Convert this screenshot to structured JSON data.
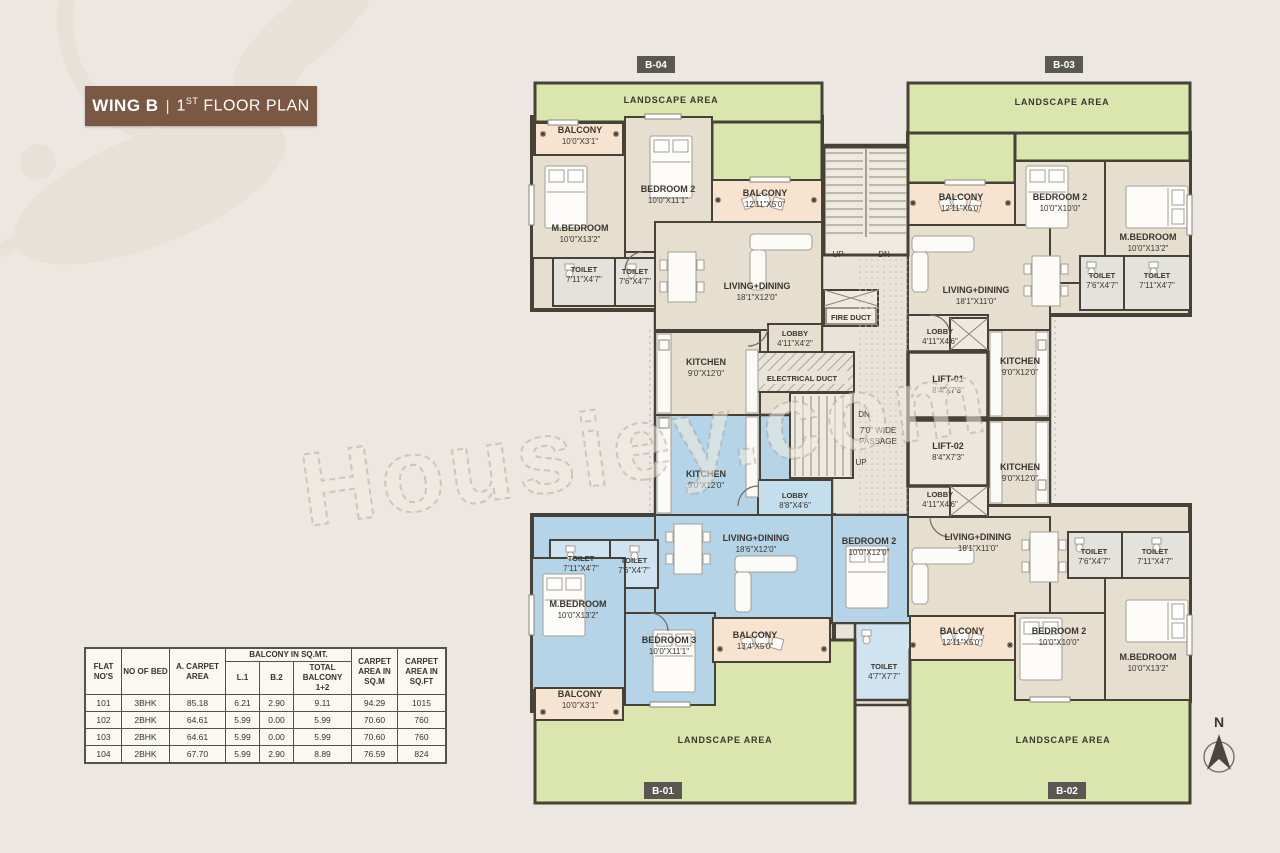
{
  "title": {
    "wing": "WING B",
    "sep": "|",
    "num": "1",
    "sup": "ST",
    "rest": " FLOOR PLAN"
  },
  "watermark": "Housiey.com",
  "compass": {
    "n": "N"
  },
  "badges": [
    "B-04",
    "B-03",
    "B-01",
    "B-02"
  ],
  "table": {
    "group_header": "BALCONY IN SQ.MT.",
    "columns": [
      "FLAT NO'S",
      "NO OF BED",
      "A. CARPET AREA",
      "L.1",
      "B.2",
      "TOTAL BALCONY 1+2",
      "CARPET AREA IN SQ.M",
      "CARPET AREA IN SQ.FT"
    ],
    "rows": [
      [
        "101",
        "3BHK",
        "85.18",
        "6.21",
        "2.90",
        "9.11",
        "94.29",
        "1015"
      ],
      [
        "102",
        "2BHK",
        "64.61",
        "5.99",
        "0.00",
        "5.99",
        "70.60",
        "760"
      ],
      [
        "103",
        "2BHK",
        "64.61",
        "5.99",
        "0.00",
        "5.99",
        "70.60",
        "760"
      ],
      [
        "104",
        "2BHK",
        "67.70",
        "5.99",
        "2.90",
        "8.89",
        "76.59",
        "824"
      ]
    ]
  },
  "plan": {
    "rooms": [
      {
        "n": "LANDSCAPE AREA",
        "d": ""
      },
      {
        "n": "BALCONY",
        "d": "10'0\"X3'1\""
      },
      {
        "n": "BEDROOM 2",
        "d": "10'0\"X11'1\""
      },
      {
        "n": "BALCONY",
        "d": "12'11\"X5'0\""
      },
      {
        "n": "M.BEDROOM",
        "d": "10'0\"X13'2\""
      },
      {
        "n": "TOILET",
        "d": "7'11\"X4'7\""
      },
      {
        "n": "TOILET",
        "d": "7'6\"X4'7\""
      },
      {
        "n": "LIVING+DINING",
        "d": "18'1\"X12'0\""
      },
      {
        "n": "KITCHEN",
        "d": "9'0\"X12'0\""
      },
      {
        "n": "LOBBY",
        "d": "4'11\"X4'2\""
      },
      {
        "n": "UP",
        "d": ""
      },
      {
        "n": "DN",
        "d": ""
      },
      {
        "n": "FIRE DUCT",
        "d": ""
      },
      {
        "n": "ELECTRICAL DUCT",
        "d": ""
      },
      {
        "n": "DN",
        "d": ""
      },
      {
        "n": "7'0\" WIDE",
        "d": "PASSAGE"
      },
      {
        "n": "UP",
        "d": ""
      },
      {
        "n": "LIFT-01",
        "d": "8'4\"X7'3\""
      },
      {
        "n": "LIFT-02",
        "d": "8'4\"X7'3\""
      },
      {
        "n": "LOBBY",
        "d": "4'11\"X4'6\""
      },
      {
        "n": "LANDSCAPE AREA",
        "d": ""
      },
      {
        "n": "BALCONY",
        "d": "12'11\"X5'0\""
      },
      {
        "n": "BEDROOM 2",
        "d": "10'0\"X10'0\""
      },
      {
        "n": "M.BEDROOM",
        "d": "10'0\"X13'2\""
      },
      {
        "n": "TOILET",
        "d": "7'6\"X4'7\""
      },
      {
        "n": "TOILET",
        "d": "7'11\"X4'7\""
      },
      {
        "n": "LIVING+DINING",
        "d": "18'1\"X11'0\""
      },
      {
        "n": "KITCHEN",
        "d": "9'0\"X12'0\""
      },
      {
        "n": "KITCHEN",
        "d": "9'0\"X12'0\""
      },
      {
        "n": "LOBBY",
        "d": "8'8\"X4'6\""
      },
      {
        "n": "LIVING+DINING",
        "d": "18'6\"X12'0\""
      },
      {
        "n": "TOILET",
        "d": "7'11\"X4'7\""
      },
      {
        "n": "TOILET",
        "d": "7'6\"X4'7\""
      },
      {
        "n": "M.BEDROOM",
        "d": "10'0\"X13'2\""
      },
      {
        "n": "BEDROOM 3",
        "d": "10'0\"X11'1\""
      },
      {
        "n": "BALCONY",
        "d": "13'4\"X5'0\""
      },
      {
        "n": "BEDROOM 2",
        "d": "10'0\"X12'0\""
      },
      {
        "n": "TOILET",
        "d": "4'7\"X7'7\""
      },
      {
        "n": "BALCONY",
        "d": "10'0\"X3'1\""
      },
      {
        "n": "LANDSCAPE AREA",
        "d": ""
      },
      {
        "n": "KITCHEN",
        "d": "9'0\"X12'0\""
      },
      {
        "n": "LOBBY",
        "d": "4'11\"X4'6\""
      },
      {
        "n": "LIVING+DINING",
        "d": "18'1\"X11'0\""
      },
      {
        "n": "TOILET",
        "d": "7'6\"X4'7\""
      },
      {
        "n": "TOILET",
        "d": "7'11\"X4'7\""
      },
      {
        "n": "BALCONY",
        "d": "12'11\"X5'0\""
      },
      {
        "n": "BEDROOM 2",
        "d": "10'0\"X10'0\""
      },
      {
        "n": "M.BEDROOM",
        "d": "10'0\"X13'2\""
      },
      {
        "n": "LANDSCAPE AREA",
        "d": ""
      }
    ]
  }
}
